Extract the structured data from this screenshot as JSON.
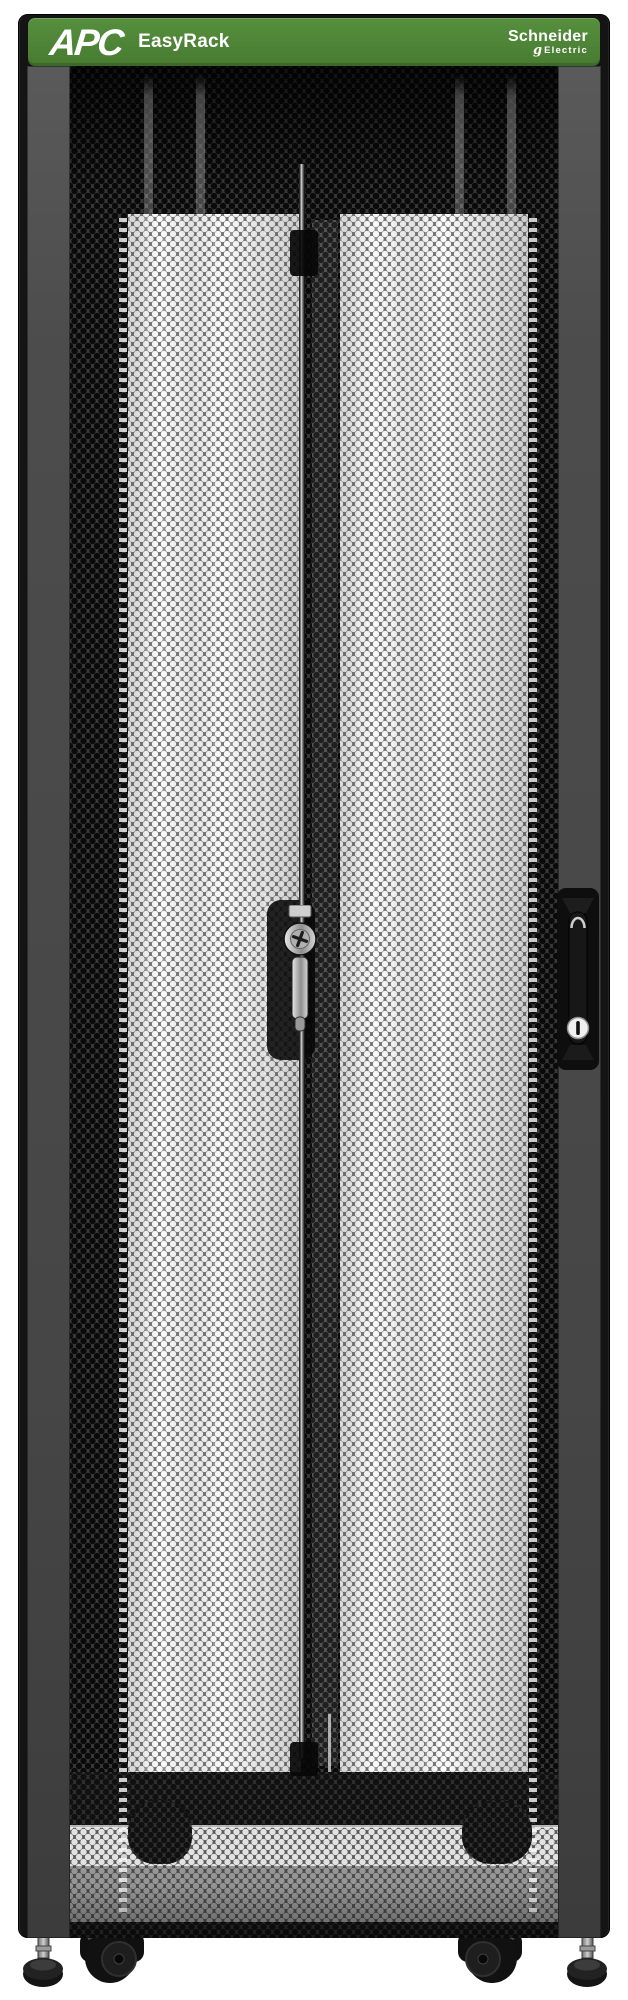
{
  "header": {
    "brand": "APC",
    "product": "EasyRack",
    "logo_line1": "Schneider",
    "logo_line2": "Electric"
  },
  "colors": {
    "header_green": "#568F3E",
    "header_green_end": "#477B31",
    "rack_black": "#141414",
    "frame_gray": "#4A4A4A",
    "mesh_web_dark": "#3A3A3A",
    "mesh_hole_dark": "#0A0A0A",
    "mesh_web_light": "#707070",
    "mesh_hole_white": "#FBFBFB",
    "lock_metal": "#C9C9C9",
    "handle_lock_face": "#F0F0F0"
  },
  "hardware": {
    "center_lock_icon": "keyed-cam-lock",
    "handle_icon": "recessed-door-handle",
    "handle_lock_icon": "keyed-cylinder-lock",
    "caster_icon": "caster-wheel",
    "foot_icon": "leveling-foot",
    "door_type": "perforated-hex-mesh-door"
  }
}
